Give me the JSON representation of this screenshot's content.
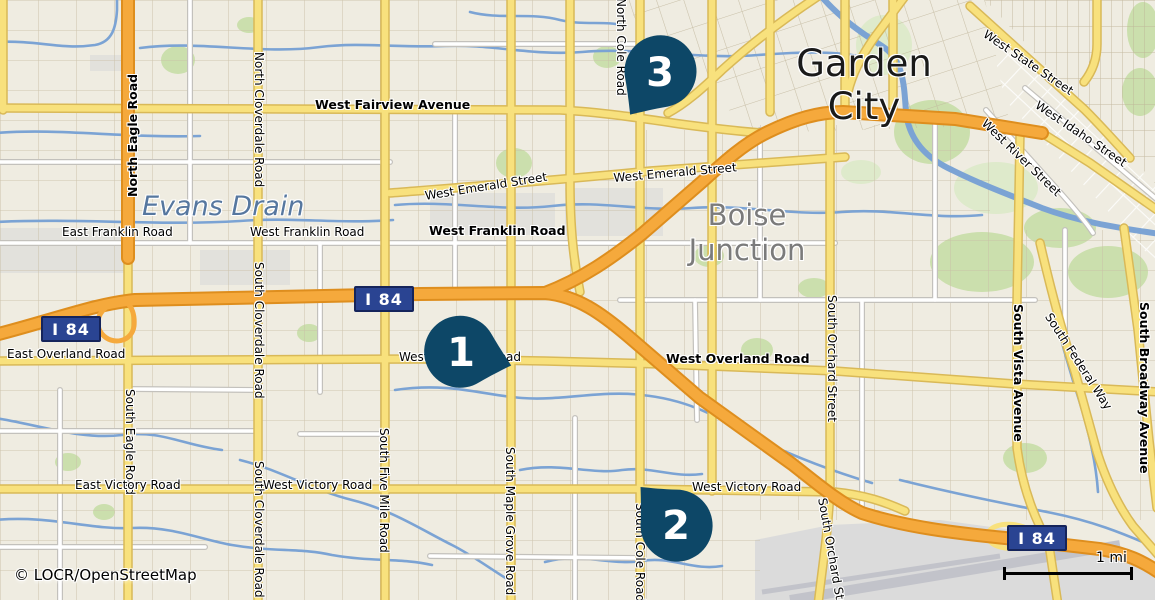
{
  "map": {
    "attribution": "© LOCR/OpenStreetMap",
    "scale_bar": {
      "label": "1 mi"
    },
    "palette": {
      "land": "#EFECE1",
      "land_gray": "#E2E1DC",
      "green": "#CBDFAD",
      "green_soft": "#DEEACB",
      "water": "#7BA3D4",
      "water_label": "#56779F",
      "texture": "#C9BFA6",
      "road_white": "#FFFFFF",
      "road_white_casing": "#C3C1BC",
      "road_yellow": "#F8E17D",
      "road_yellow_casing": "#D9B958",
      "road_orange": "#F5A93C",
      "road_orange_casing": "#DE8E1E",
      "shield_bg": "#2A4492",
      "shield_border": "#15245B",
      "shield_text": "#FFFFFF",
      "pin": "#0D4767",
      "pin_text": "#FFFFFF",
      "label": "#000000",
      "halo": "#FFFFFF",
      "place": "#1A1A1A",
      "place_gray": "#7B7B7B",
      "airport": "#DBDBDB",
      "runway": "#C2C3CA"
    },
    "shields": [
      {
        "label": "I 84",
        "x": 71,
        "y": 329
      },
      {
        "label": "I 84",
        "x": 384,
        "y": 299
      },
      {
        "label": "I 84",
        "x": 1037,
        "y": 538
      }
    ],
    "markers": [
      {
        "number": "1",
        "x": 461,
        "y": 352,
        "rotation": -75
      },
      {
        "number": "2",
        "x": 676,
        "y": 525,
        "rotation": 137
      },
      {
        "number": "3",
        "x": 660,
        "y": 72,
        "rotation": 35
      }
    ],
    "labels": [
      {
        "text": "West Fairview Avenue",
        "x": 315,
        "y": 98,
        "rot": 0,
        "cls": "street-bold"
      },
      {
        "text": "North Eagle Road",
        "x": 126,
        "y": 197,
        "rot": -90,
        "cls": "street-bold"
      },
      {
        "text": "North Cloverdale Road",
        "x": 265,
        "y": 52,
        "rot": 90,
        "cls": "street"
      },
      {
        "text": "North Cole Road",
        "x": 627,
        "y": -2,
        "rot": 90,
        "cls": "street"
      },
      {
        "text": "Evans Drain",
        "x": 142,
        "y": 191,
        "rot": 0,
        "cls": "water-name"
      },
      {
        "text": "East Franklin Road",
        "x": 62,
        "y": 226,
        "rot": 0,
        "cls": "street"
      },
      {
        "text": "West Franklin Road",
        "x": 250,
        "y": 226,
        "rot": 0,
        "cls": "street"
      },
      {
        "text": "West Franklin Road",
        "x": 429,
        "y": 224,
        "rot": 0,
        "cls": "street-bold"
      },
      {
        "text": "West Emerald Street",
        "x": 424,
        "y": 190,
        "rot": -9,
        "cls": "street"
      },
      {
        "text": "West Emerald Street",
        "x": 613,
        "y": 172,
        "rot": -5,
        "cls": "street"
      },
      {
        "text": "Garden\nCity",
        "x": 864,
        "y": 42,
        "rot": 0,
        "cls": "place"
      },
      {
        "text": "Boise\nJunction",
        "x": 747,
        "y": 198,
        "rot": 0,
        "cls": "place-gray"
      },
      {
        "text": "West State Street",
        "x": 988,
        "y": 28,
        "rot": 34,
        "cls": "street"
      },
      {
        "text": "West Idaho Street",
        "x": 1040,
        "y": 99,
        "rot": 34,
        "cls": "street"
      },
      {
        "text": "West River Street",
        "x": 988,
        "y": 117,
        "rot": 44,
        "cls": "street"
      },
      {
        "text": "East Overland Road",
        "x": 7,
        "y": 348,
        "rot": 0,
        "cls": "street"
      },
      {
        "text": "West Overland Road",
        "x": 399,
        "y": 351,
        "rot": 0,
        "cls": "street"
      },
      {
        "text": "West Overland Road",
        "x": 666,
        "y": 352,
        "rot": 0,
        "cls": "street-bold"
      },
      {
        "text": "South Cloverdale Road",
        "x": 265,
        "y": 262,
        "rot": 90,
        "cls": "street"
      },
      {
        "text": "South Cloverdale Road",
        "x": 265,
        "y": 461,
        "rot": 90,
        "cls": "street"
      },
      {
        "text": "South Eagle Road",
        "x": 136,
        "y": 389,
        "rot": 90,
        "cls": "street"
      },
      {
        "text": "South Five Mile Road",
        "x": 390,
        "y": 428,
        "rot": 90,
        "cls": "street"
      },
      {
        "text": "South Maple Grove Road",
        "x": 516,
        "y": 447,
        "rot": 90,
        "cls": "street"
      },
      {
        "text": "South Cole Road",
        "x": 646,
        "y": 503,
        "rot": 90,
        "cls": "street"
      },
      {
        "text": "East Victory Road",
        "x": 75,
        "y": 479,
        "rot": 0,
        "cls": "street"
      },
      {
        "text": "West Victory Road",
        "x": 263,
        "y": 479,
        "rot": 0,
        "cls": "street"
      },
      {
        "text": "West Victory Road",
        "x": 692,
        "y": 481,
        "rot": 0,
        "cls": "street"
      },
      {
        "text": "South Orchard Street",
        "x": 838,
        "y": 295,
        "rot": 90,
        "cls": "street"
      },
      {
        "text": "South Orchard Street",
        "x": 828,
        "y": 497,
        "rot": 80,
        "cls": "street"
      },
      {
        "text": "South Vista Avenue",
        "x": 1025,
        "y": 304,
        "rot": 90,
        "cls": "street-bold"
      },
      {
        "text": "South Federal Way",
        "x": 1053,
        "y": 311,
        "rot": 57,
        "cls": "street"
      },
      {
        "text": "South Broadway Avenue",
        "x": 1151,
        "y": 302,
        "rot": 90,
        "cls": "street-bold"
      }
    ]
  }
}
